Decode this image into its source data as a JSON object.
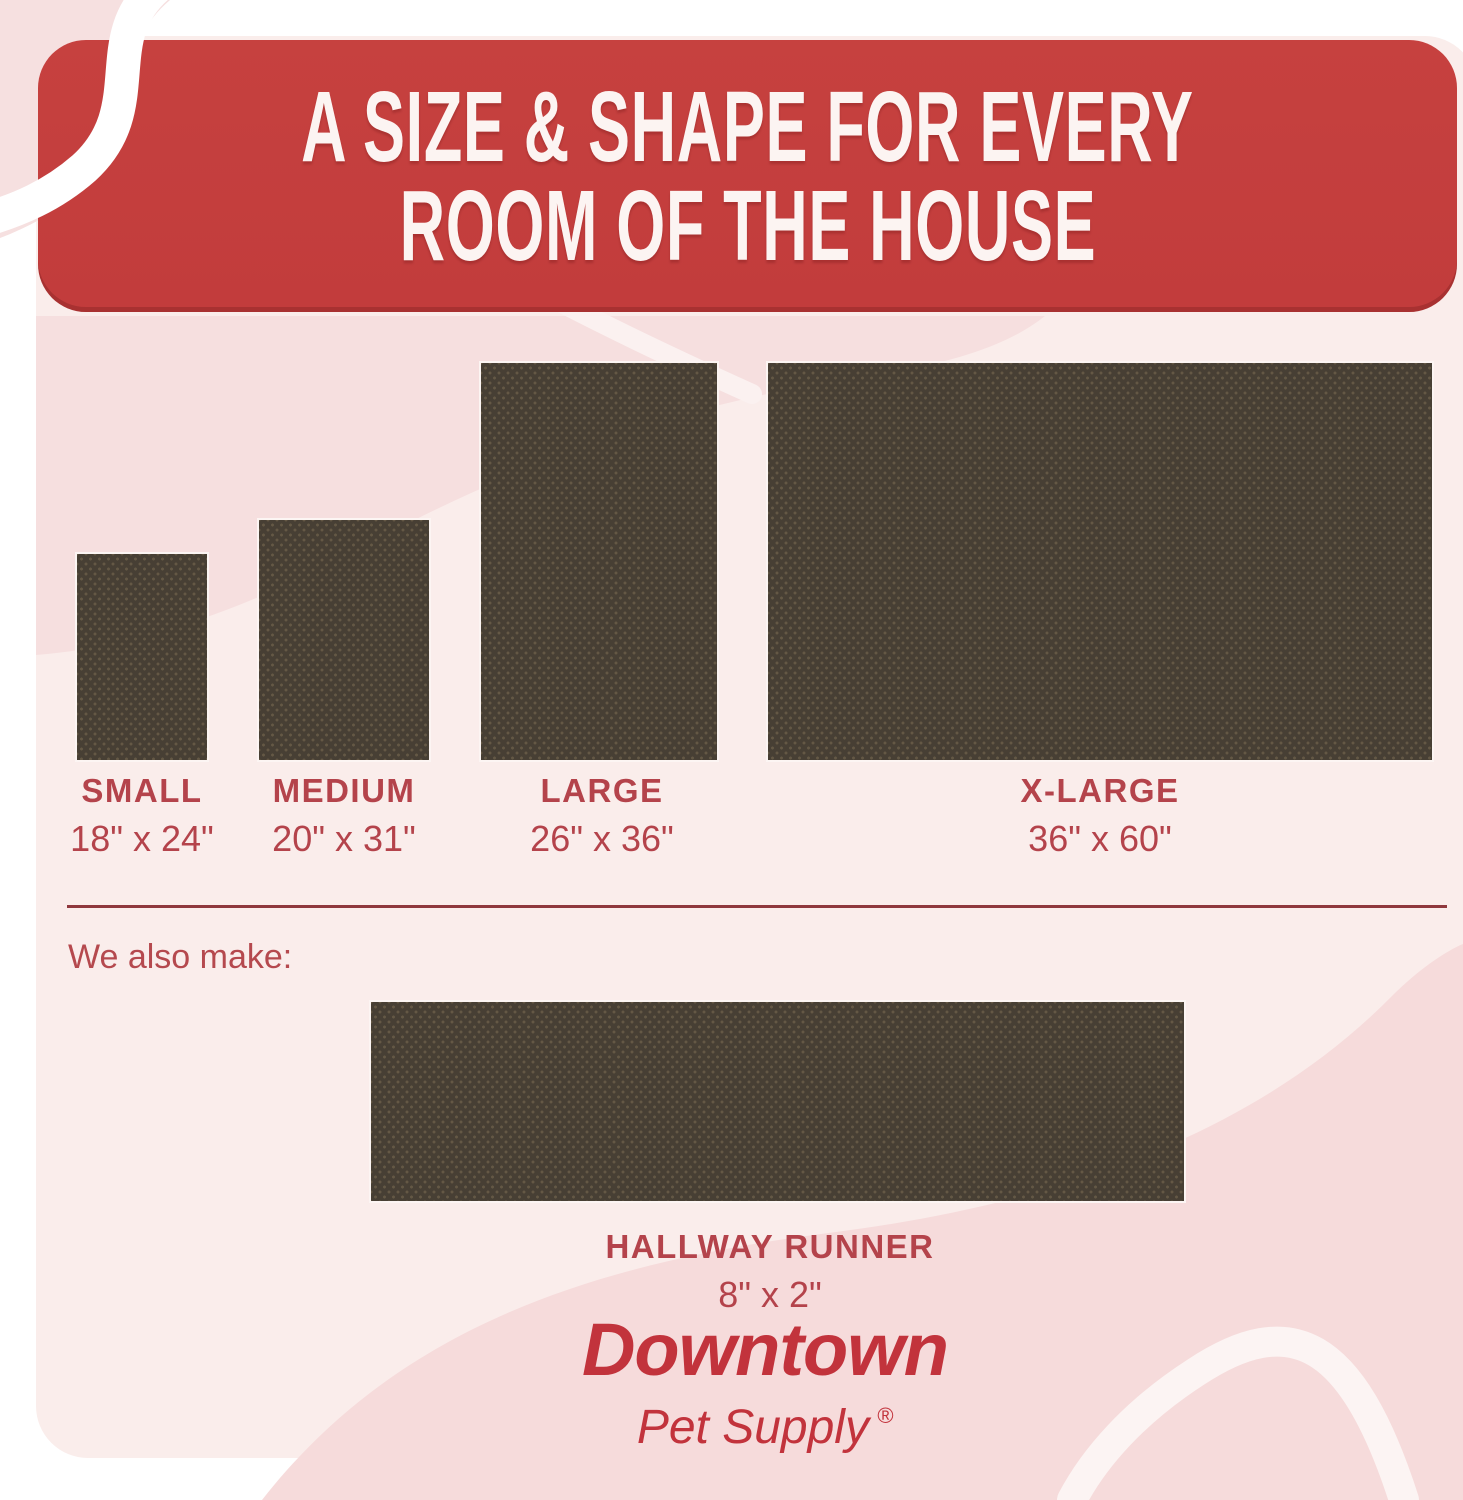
{
  "header": {
    "title_line_1": "A SIZE & SHAPE FOR EVERY",
    "title_line_2": "ROOM OF THE HOUSE"
  },
  "sizes": [
    {
      "name": "SMALL",
      "dimensions": "18\" x 24\""
    },
    {
      "name": "MEDIUM",
      "dimensions": "20\" x 31\""
    },
    {
      "name": "LARGE",
      "dimensions": "26\" x 36\""
    },
    {
      "name": "X-LARGE",
      "dimensions": "36\" x 60\""
    }
  ],
  "also_make": {
    "intro": "We also make:",
    "runner_name": "HALLWAY RUNNER",
    "runner_dimensions": "8\" x 2\""
  },
  "brand": {
    "name": "Downtown",
    "subtitle": "Pet Supply",
    "registered_mark": "®"
  },
  "colors": {
    "header_red": "#C6413F",
    "label_red": "#B4434B",
    "brand_red": "#C2333C",
    "divider_red": "#8F383D",
    "mat_brown": "#473F34",
    "panel_pink": "#FAEDEB",
    "accent_pink": "#F6DEDE"
  }
}
